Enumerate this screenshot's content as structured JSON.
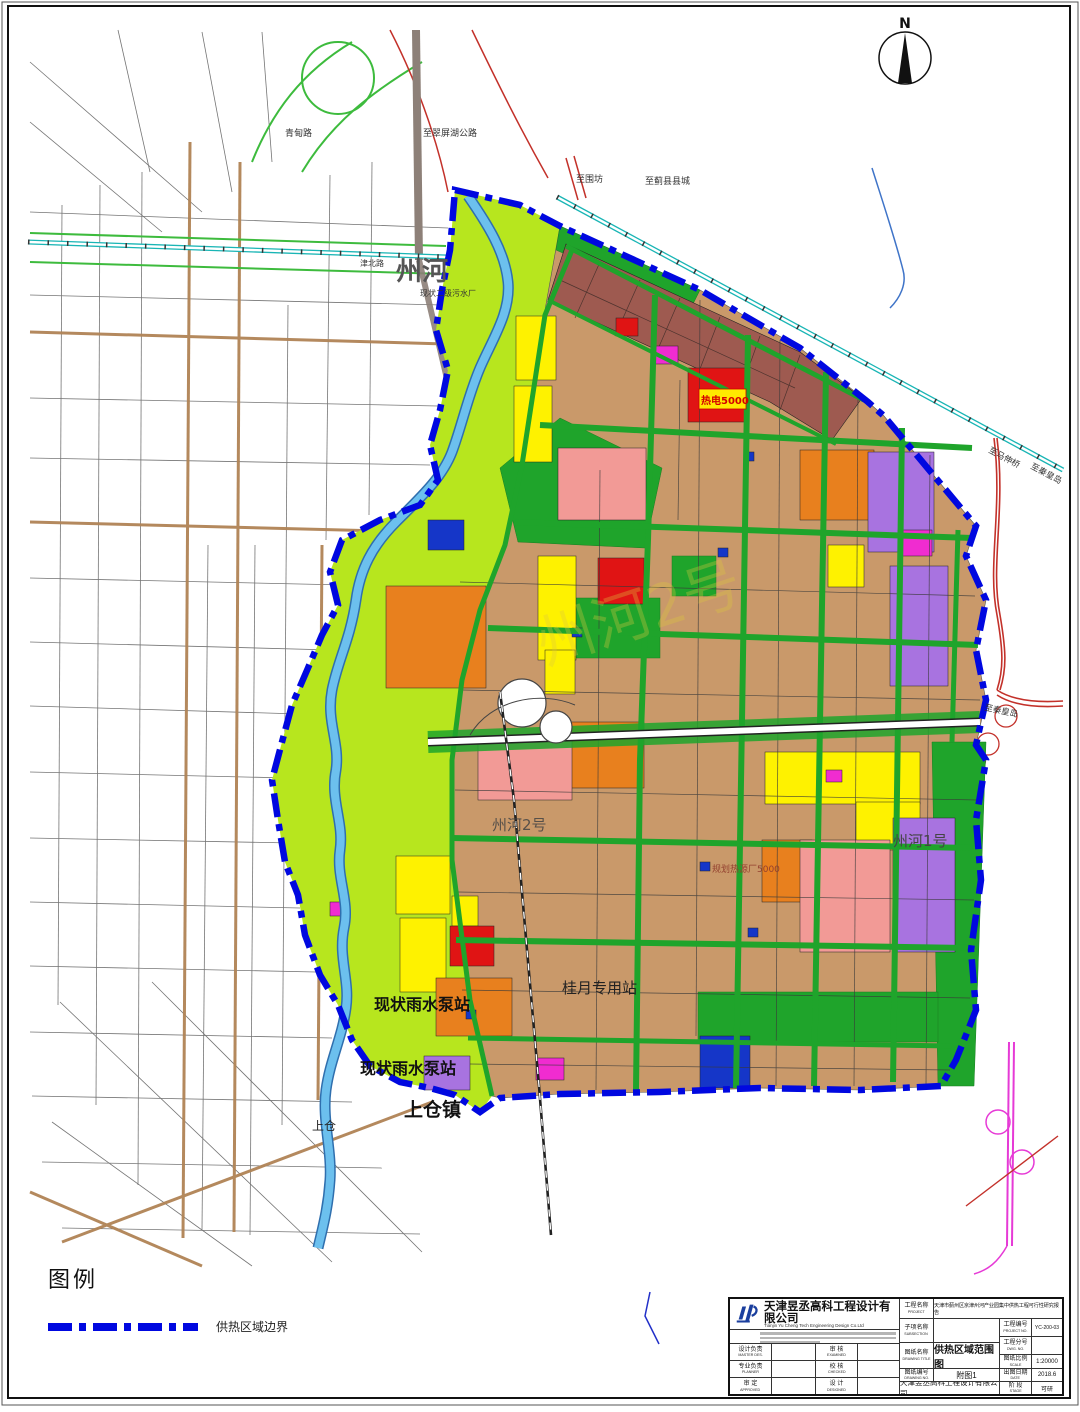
{
  "north_arrow": {
    "label": "N"
  },
  "map": {
    "labels": {
      "qingdian_road": "青甸路",
      "to_cuipinghu_highway": "至翠屏湖公路",
      "to_weifang": "至围坊",
      "to_jixian_county": "至蓟县县城",
      "jinbei_road": "津北路",
      "zhouhe_river": "州河",
      "existing_sewage_plant": "现状二级污水厂",
      "to_mashenqiao": "至马伸桥",
      "to_qinhuangdao_rail": "至秦皇岛",
      "to_qinhuangdao_expressway": "至秦皇岛",
      "heat_plant_5000": "热电5000",
      "planned_heat_source_5000": "规划热源厂5000",
      "zhouhe_no1": "州河1号",
      "zhouhe_no2": "州河2号",
      "guiyue_dedicated_station": "桂月专用站",
      "existing_rain_pump_station_1": "现状雨水泵站",
      "existing_rain_pump_station_2": "现状雨水泵站",
      "shangcang_town": "上仓镇",
      "shangcang": "上仓",
      "watermark": "州河2号"
    },
    "colors": {
      "heating_boundary": "#0008e0",
      "green_corridor": "#b7e61e",
      "park_green": "#1fa42b",
      "residential_tan": "#c9996a",
      "village_maroon": "#9e5a50",
      "industrial_orange": "#e8801e",
      "public_yellow": "#fef200",
      "commercial_red": "#e01414",
      "residential_pink": "#f29a96",
      "logistics_purple": "#a873e0",
      "special_magenta": "#f02cd0",
      "utility_blue": "#1536c8",
      "river_blue": "#6cc0ee",
      "railway_teal": "#19b5b5",
      "expressway_red": "#c3312a",
      "interchange_pink": "#e63ad6"
    }
  },
  "legend": {
    "title": "图例",
    "items": [
      {
        "label": "供热区域边界"
      }
    ]
  },
  "title_block": {
    "company_cn": "天津昱丞高科工程设计有限公司",
    "company_en": "Tianjin Yu Cheng Tech  Engineering Design Co.Ltd",
    "project_label": "工程名称",
    "project_label_en": "PROJECT",
    "project_value": "天津市蓟州区京津州河产业园集中供热工程可行性研究报告",
    "subsection_label": "子项名称",
    "subsection_label_en": "SUBSECTION",
    "subsection_value": "",
    "drawing_title_label": "图纸名称",
    "drawing_title_label_en": "DRAWING TITLE",
    "drawing_title_value": "供热区域范围图",
    "drawing_no_label": "图纸编号",
    "drawing_no_label_en": "DRAWING NO.",
    "drawing_no_value": "附图1",
    "project_no_label": "工程编号",
    "project_no_label_en": "PROJECT NO.",
    "project_no_value": "YC-200-03",
    "sub_no_label": "工程分号",
    "sub_no_label_en": "DWG. NO.",
    "sub_no_value": "",
    "scale_label": "图纸比例",
    "scale_label_en": "SCALE",
    "scale_value": "1:20000",
    "date_label": "出图日期",
    "date_label_en": "DATE",
    "date_value": "2018.6",
    "stage_label": "阶 段",
    "stage_label_en": "STAGE",
    "stage_value": "可研",
    "master_label": "设计负责",
    "master_label_en": "MASTER DES.",
    "planner_label": "专业负责",
    "planner_label_en": "PLANNER",
    "approved_label": "审 定",
    "approved_label_en": "APPROVED",
    "examined_label": "审 核",
    "examined_label_en": "EXAMINED",
    "checked_label": "校 核",
    "checked_label_en": "CHECKED",
    "designed_label": "设 计",
    "designed_label_en": "DESIGNED",
    "footer_company": "天津昱丞高科工程设计有限公司"
  }
}
